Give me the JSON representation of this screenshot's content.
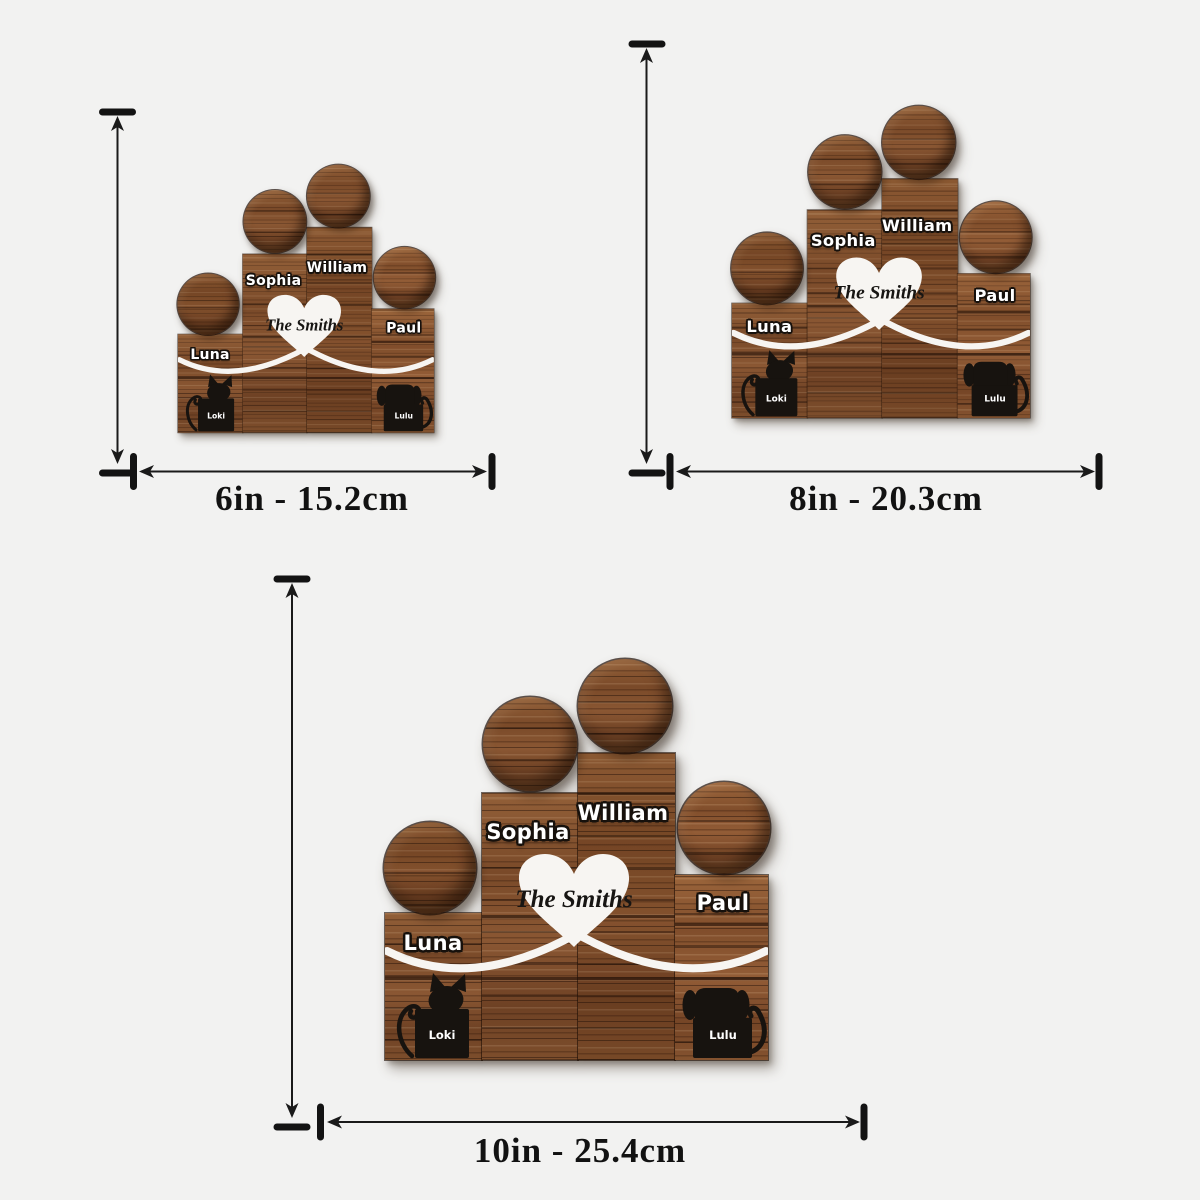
{
  "page": {
    "background": "#f2f2f1"
  },
  "product": {
    "family_name": "The Smiths",
    "members": [
      {
        "name": "Luna"
      },
      {
        "name": "Sophia"
      },
      {
        "name": "William"
      },
      {
        "name": "Paul"
      }
    ],
    "pets": [
      {
        "name": "Loki",
        "type": "cat"
      },
      {
        "name": "Lulu",
        "type": "dog"
      }
    ]
  },
  "sizes": [
    {
      "label": "6in - 15.2cm"
    },
    {
      "label": "8in - 20.3cm"
    },
    {
      "label": "10in - 25.4cm"
    }
  ],
  "colors": {
    "wood_mid": "#7c4d2b",
    "wood_dark": "#4a2a16",
    "wood_light": "#9a6a42",
    "heart": "#f7f5f2",
    "silhouette": "#17130f",
    "arrow": "#131313",
    "name_text": "#ffffff",
    "label_text": "#121212"
  }
}
